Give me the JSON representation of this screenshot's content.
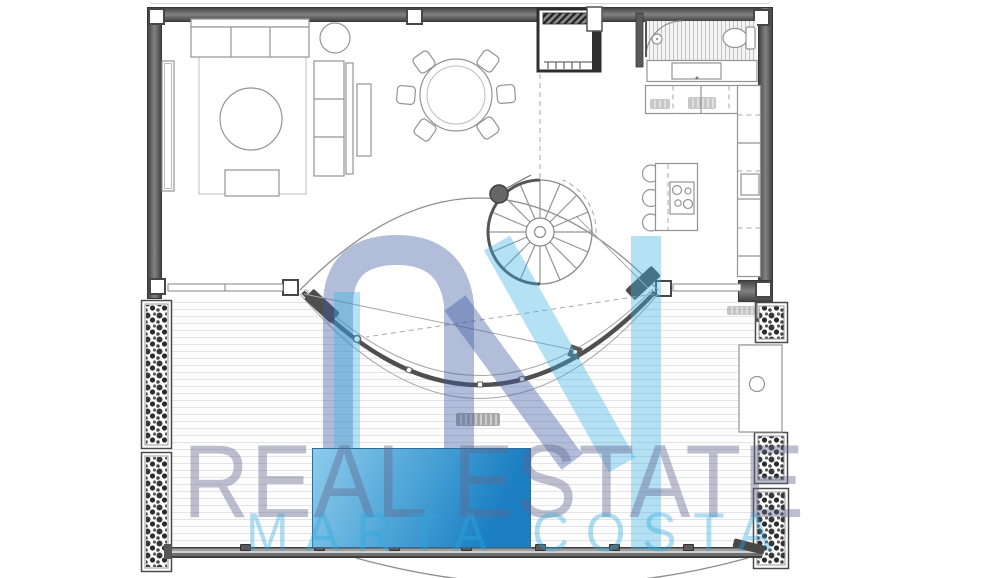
{
  "watermark": {
    "logo_monogram": "M",
    "line1": "REAL ESTATE",
    "line2": "MARTA COSTA"
  },
  "colors": {
    "wall": "#5e5e5e",
    "furniture_line": "#949494",
    "deck_plank": "#e4e4e8",
    "pool_light": "#8ecbec",
    "pool_dark": "#1b7fc2",
    "watermark_text1": "rgba(98,102,140,0.42)",
    "watermark_text2": "rgba(45,168,220,0.38)",
    "watermark_logo_lavender": "rgba(60,90,160,0.40)",
    "watermark_logo_cyan": "rgba(60,175,230,0.38)"
  }
}
